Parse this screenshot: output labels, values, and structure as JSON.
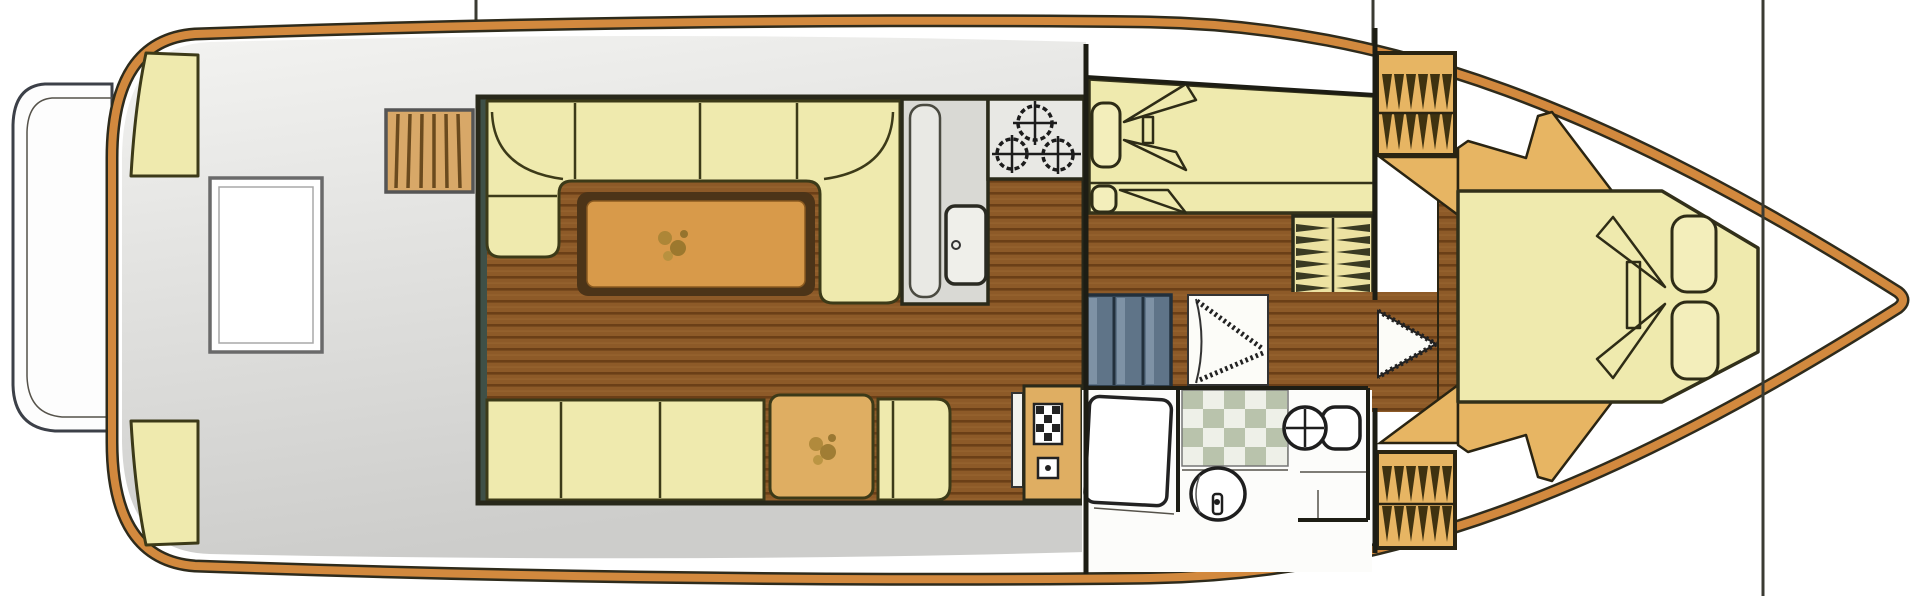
{
  "title": "Motor yacht accommodation floor plan",
  "palette": {
    "background": "#ffffff",
    "hull_trim": "#d2893e",
    "hull_outline": "#2e2b1c",
    "deck_gray_top": "#f3f3f1",
    "deck_gray_bottom": "#cdcdcb",
    "cushion": "#efeaae",
    "cushion_outline": "#3c3a18",
    "pillow": "#f3eebb",
    "wood_base": "#8d5a28",
    "wood_plank_line": "#6b3f17",
    "table_wood": "#d89a4a",
    "table_border": "#4c3418",
    "furniture_tan": "#dfae62",
    "counter_gray": "#d9d9d4",
    "stove_white": "#e8e8e4",
    "steps_tan": "#d8a868",
    "steps_blue": "#5f7488",
    "steps_blue_highlight": "#8ba0b2",
    "hatch_tan": "#e7b563",
    "hatch_teeth": "#3f3210",
    "checker_green": "#b9c3ac",
    "checker_light": "#eef0e8",
    "louver_cream": "#ece2a2",
    "wall_teal": "#3f5047",
    "plant_green": "#96752c",
    "door_white": "#fcfcf8",
    "section_line": "#3b3b33",
    "platform_white": "#fdfdfd"
  },
  "areas": [
    {
      "id": "swim-platform",
      "label": "swim platform"
    },
    {
      "id": "aft-deck",
      "label": "aft deck",
      "features": [
        "corner seat x2",
        "deck table",
        "side steps"
      ]
    },
    {
      "id": "salon",
      "label": "salon",
      "features": [
        "U-shaped sofa",
        "dining table with plant",
        "bench seat",
        "side table with plant",
        "corner cushions"
      ]
    },
    {
      "id": "galley",
      "label": "galley",
      "features": [
        "counter",
        "sink with drain",
        "3-burner stove"
      ]
    },
    {
      "id": "mid-cabin",
      "label": "mid cabin",
      "features": [
        "double berth",
        "2 pillows",
        "louvered wardrobe"
      ]
    },
    {
      "id": "companionway",
      "label": "companionway",
      "features": [
        "3-tread steps",
        "bi-fold door"
      ]
    },
    {
      "id": "bathroom",
      "label": "bathroom",
      "features": [
        "checkered tile floor",
        "toilet",
        "washbasin",
        "door"
      ]
    },
    {
      "id": "bow-cabin",
      "label": "bow cabin",
      "features": [
        "V-berth",
        "2 pillows",
        "side shelves",
        "entry door",
        "deck hatch x2"
      ]
    }
  ],
  "fixture_counts": {
    "berths": 3,
    "pillows": 4,
    "stove_burners": 3,
    "step_flights": 3,
    "deck_hatches": 2
  }
}
